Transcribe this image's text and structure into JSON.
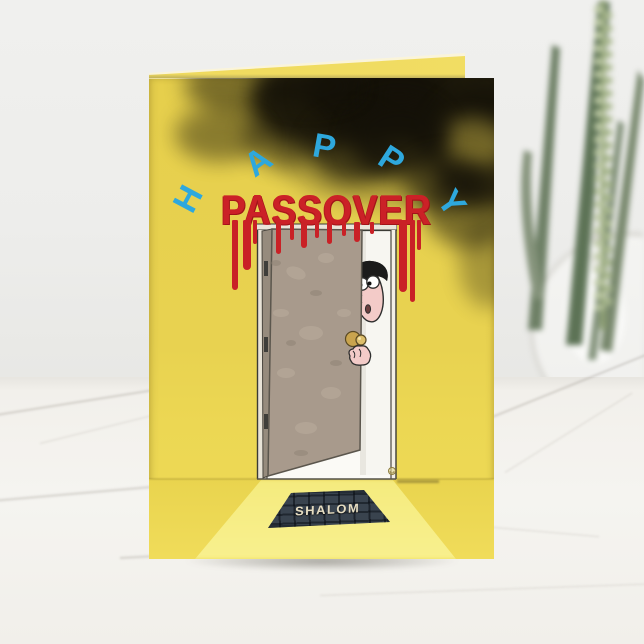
{
  "card": {
    "headline_word": "HAPPY",
    "headline_letters": [
      "H",
      "A",
      "P",
      "P",
      "Y"
    ],
    "title": "PASSOVER",
    "doormat_text": "SHALOM"
  },
  "colors": {
    "card_yellow": "#E8D250",
    "happy_blue": "#2EA8DD",
    "passover_red": "#C92126",
    "door_taupe": "#A89A8C",
    "door_frame_white": "#F3EFE6",
    "doormat_slate": "#39434E",
    "doormat_text_cream": "#E6DDC2",
    "smoke_black": "#141108",
    "light_beam_yellow": "#F7EE86",
    "wall_gray": "#EDEDEB",
    "marble_white": "#F4F3EF",
    "plant_green": "#5D7356",
    "skin_pink": "#F3CBC8",
    "doorknob_gold": "#C9A44E"
  }
}
